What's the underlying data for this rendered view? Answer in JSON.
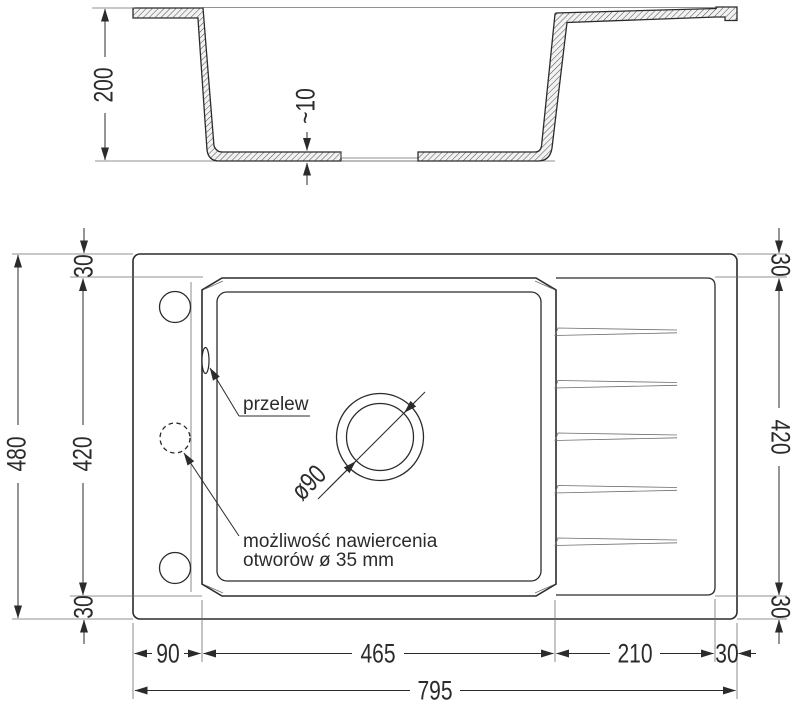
{
  "colors": {
    "line": "#2b2b2b",
    "thin_line": "#6e6e6e",
    "background": "#ffffff"
  },
  "section_view": {
    "height": "200",
    "bottom_thickness": "~10"
  },
  "plan_view": {
    "overall_width": "795",
    "overall_depth": "480",
    "bowl_width": "465",
    "bowl_depth": "420",
    "left_offset": "90",
    "drainer_width": "210",
    "right_edge": "30",
    "rim_top_left": "30",
    "rim_bottom_left": "30",
    "rim_top_right": "30",
    "rim_bottom_right": "30",
    "drain_diameter": "ø90",
    "overflow_label": "przelew",
    "drill_note_line1": "możliwość nawiercenia",
    "drill_note_line2": "otworów ø 35 mm"
  }
}
